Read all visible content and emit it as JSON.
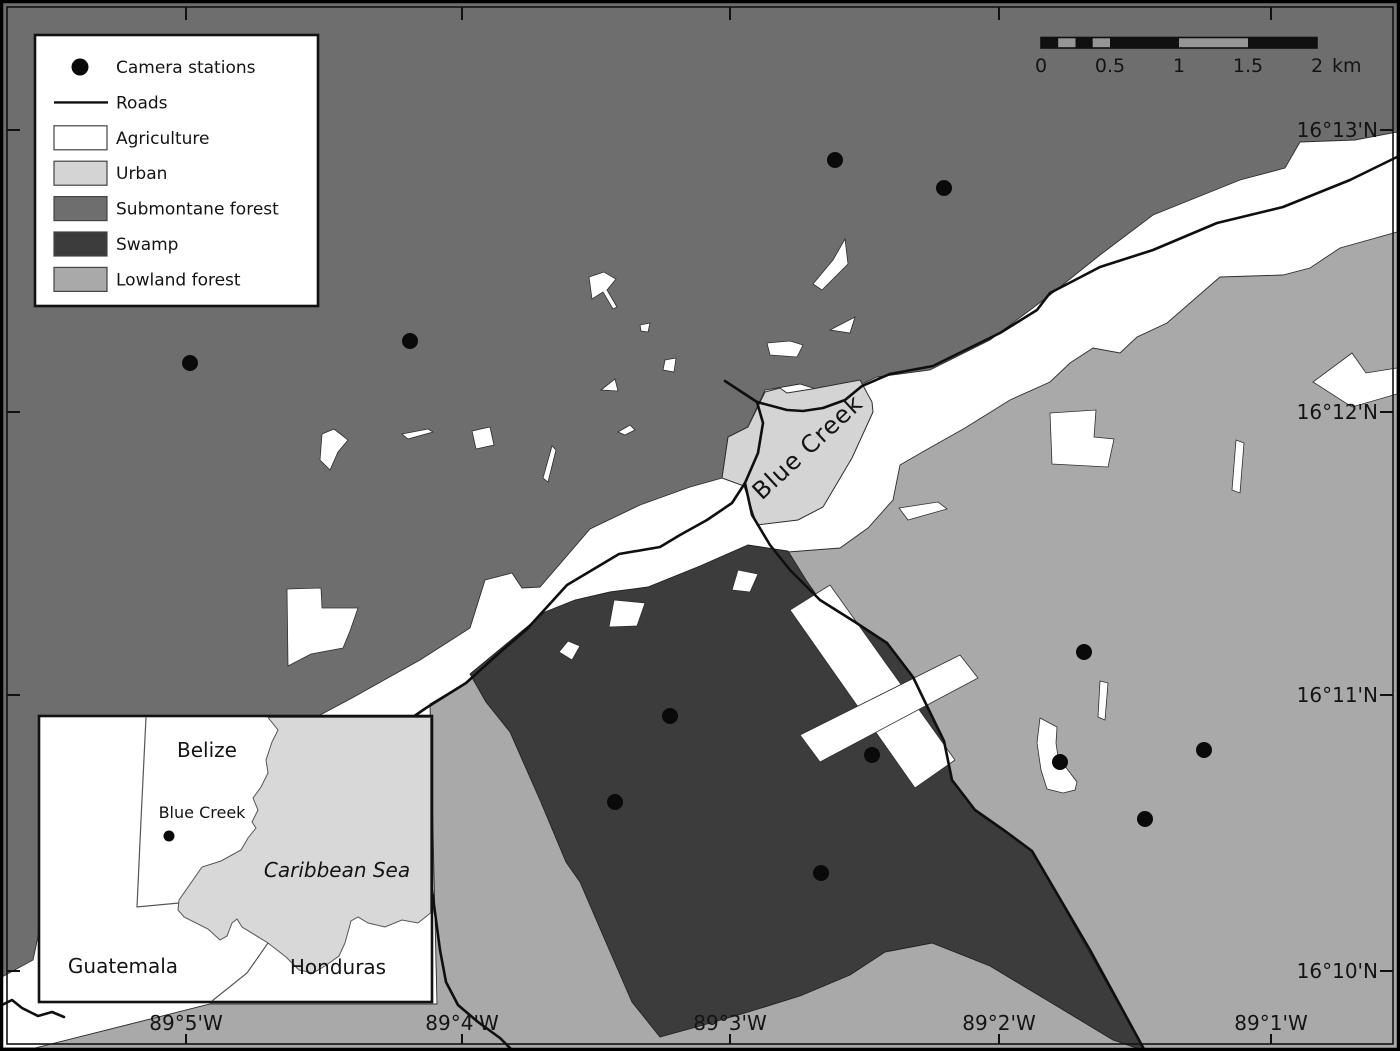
{
  "colors": {
    "agriculture": "#ffffff",
    "urban": "#d4d4d4",
    "submontane_forest": "#6e6e6e",
    "swamp": "#3c3c3c",
    "lowland_forest": "#a9a9a9",
    "sea": "#d8d8d8",
    "road": "#0f0f0f",
    "scalebar_alt": "#969696"
  },
  "legend": {
    "items": [
      {
        "swatch": "dot",
        "label": "Camera stations"
      },
      {
        "swatch": "line",
        "label": "Roads"
      },
      {
        "swatch": "rect",
        "color": "#ffffff",
        "label": "Agriculture"
      },
      {
        "swatch": "rect",
        "color": "#d4d4d4",
        "label": "Urban"
      },
      {
        "swatch": "rect",
        "color": "#6e6e6e",
        "label": "Submontane forest"
      },
      {
        "swatch": "rect",
        "color": "#3c3c3c",
        "label": "Swamp"
      },
      {
        "swatch": "rect",
        "color": "#a9a9a9",
        "label": "Lowland forest"
      }
    ]
  },
  "scalebar": {
    "x0": 1041,
    "px_per_km": 138,
    "boundaries_km": [
      0,
      0.125,
      0.25,
      0.375,
      0.5,
      1,
      1.5,
      2
    ],
    "tick_labels": [
      {
        "km": 0,
        "text": "0"
      },
      {
        "km": 0.5,
        "text": "0.5"
      },
      {
        "km": 1,
        "text": "1"
      },
      {
        "km": 1.5,
        "text": "1.5"
      },
      {
        "km": 2,
        "text": "2"
      }
    ],
    "unit": "km"
  },
  "graticule": {
    "lon": [
      {
        "label": "89°5'W",
        "x": 186
      },
      {
        "label": "89°4'W",
        "x": 462
      },
      {
        "label": "89°3'W",
        "x": 730
      },
      {
        "label": "89°2'W",
        "x": 999
      },
      {
        "label": "89°1'W",
        "x": 1271
      }
    ],
    "lat": [
      {
        "label": "16°13'N",
        "y": 130
      },
      {
        "label": "16°12'N",
        "y": 412
      },
      {
        "label": "16°11'N",
        "y": 695
      },
      {
        "label": "16°10'N",
        "y": 971
      }
    ]
  },
  "map_labels": {
    "town": "Blue Creek"
  },
  "camera_stations": [
    [
      190,
      363
    ],
    [
      410,
      341
    ],
    [
      835,
      160
    ],
    [
      944,
      188
    ],
    [
      670,
      716
    ],
    [
      872,
      755
    ],
    [
      615,
      802
    ],
    [
      821,
      873
    ],
    [
      1084,
      652
    ],
    [
      1060,
      762
    ],
    [
      1204,
      750
    ],
    [
      1145,
      819
    ]
  ],
  "inset": {
    "labels": {
      "belize": "Belize",
      "blue_creek": "Blue Creek",
      "caribbean_sea": "Caribbean Sea",
      "guatemala": "Guatemala",
      "honduras": "Honduras"
    }
  }
}
